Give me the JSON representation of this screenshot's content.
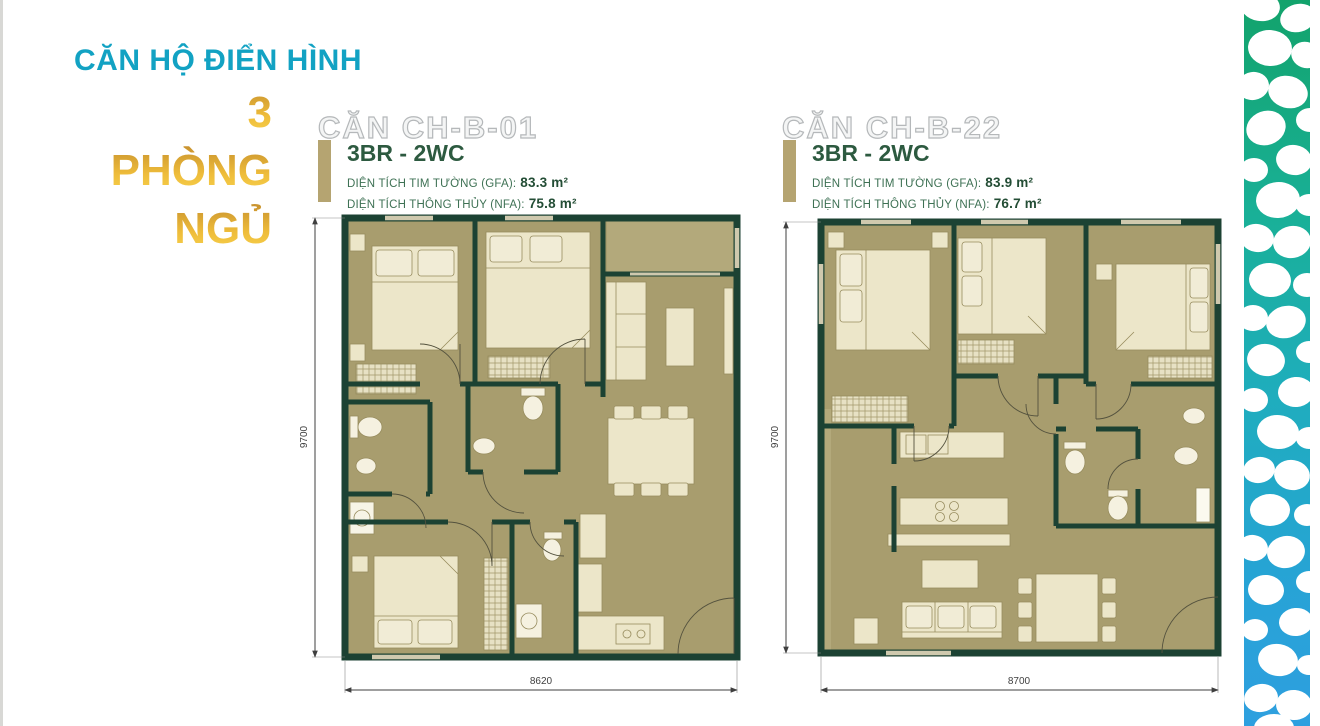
{
  "header": {
    "title": "CĂN HỘ ĐIỂN HÌNH",
    "count": "3",
    "count_word1": "PHÒNG",
    "count_word2": "NGỦ"
  },
  "plans": [
    {
      "name": "CĂN CH-B-01",
      "type": "3BR - 2WC",
      "gfa_label": "DIỆN TÍCH TIM TƯỜNG (GFA):",
      "gfa_value": "83.3 m²",
      "nfa_label": "DIỆN TÍCH THÔNG THỦY (NFA):",
      "nfa_value": "75.8 m²",
      "dim_width": "8620",
      "dim_height": "9700"
    },
    {
      "name": "CĂN CH-B-22",
      "type": "3BR - 2WC",
      "gfa_label": "DIỆN TÍCH TIM TƯỜNG (GFA):",
      "gfa_value": "83.9 m²",
      "nfa_label": "DIỆN TÍCH THÔNG THỦY (NFA):",
      "nfa_value": "76.7 m²",
      "dim_width": "8700",
      "dim_height": "9700"
    }
  ],
  "colors": {
    "accent_teal": "#12a2c3",
    "gold_dark": "#c9932f",
    "gold_light": "#f9d44f",
    "wall_green": "#1c4233",
    "floor_khaki": "#a89d6e",
    "furniture_cream": "#ece6c9",
    "text_green": "#2d5a40",
    "pattern_green": "#15a36e",
    "pattern_blue": "#2f9fe0"
  }
}
